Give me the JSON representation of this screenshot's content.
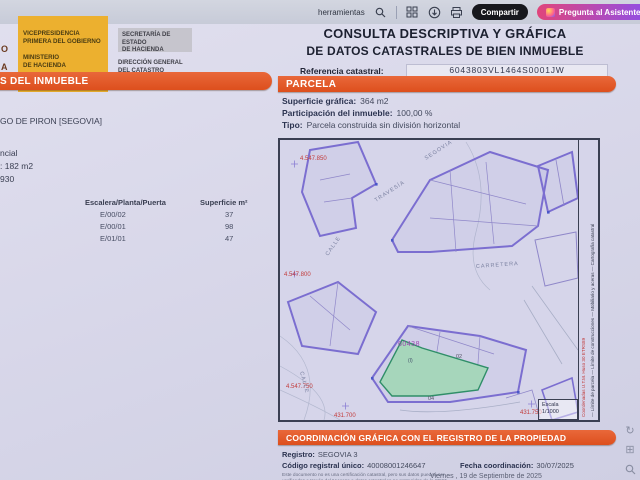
{
  "toolbar": {
    "tools_label": "herramientas",
    "share_label": "Compartir",
    "assistant_label": "Pregunta al Asistente"
  },
  "header": {
    "logo_partial_1": "O",
    "logo_partial_2": "A",
    "gov_box_line1": "VICEPRESIDENCIA",
    "gov_box_line2": "PRIMERA DEL GOBIERNO",
    "gov_box_line3": "MINISTERIO",
    "gov_box_line4": "DE HACIENDA",
    "secretary_line1": "SECRETARÍA DE ESTADO",
    "secretary_line2": "DE HACIENDA",
    "directorate_line1": "DIRECCIÓN GENERAL",
    "directorate_line2": "DEL CATASTRO",
    "title_line1": "CONSULTA DESCRIPTIVA Y GRÁFICA",
    "title_line2": "DE DATOS CATASTRALES DE BIEN INMUEBLE",
    "ref_label": "Referencia catastral:",
    "ref_value": "6043803VL1464S0001JW"
  },
  "left_panel": {
    "section_title": "S DEL INMUEBLE",
    "location_partial": "GO DE PIRON [SEGOVIA]",
    "use_partial": "ncial",
    "area_partial": ": 182 m2",
    "year_partial": "930",
    "table": {
      "col1": "Escalera/Planta/Puerta",
      "col2": "Superficie m²",
      "rows": [
        {
          "unit": "E/00/02",
          "area": "37"
        },
        {
          "unit": "E/00/01",
          "area": "98"
        },
        {
          "unit": "E/01/01",
          "area": "47"
        }
      ]
    }
  },
  "parcel_panel": {
    "section_title": "PARCELA",
    "graphic_area_label": "Superficie gráfica:",
    "graphic_area_value": "364 m2",
    "participation_label": "Participación del inmueble:",
    "participation_value": "100,00 %",
    "type_label": "Tipo:",
    "type_value": "Parcela construida sin división horizontal"
  },
  "map": {
    "street_travesia": "TRAVESÍA",
    "street_segovia": "SEGOVIA",
    "street_calle_left": "CALLE",
    "street_calle_bottom": "CALLE",
    "street_carretera": "CARRETERA",
    "coord_top": "4.547.850",
    "coord_mid": "4.547.800",
    "coord_bottom": "4.547.750",
    "coord_x1": "431.700",
    "coord_x2": "431.750",
    "block_number": "60438",
    "parcel_label_1": "(I)",
    "parcel_label_2": "02",
    "parcel_label_3": "04",
    "legend_red": "Coordenadas U.T.M. Huso 30 ETRS89",
    "legend_items": "— Límite de parcela   — Límite de construcciones   — Mobiliario y aceras   — Cartografía catastral",
    "scale_label": "Escala",
    "scale_value": "1/1000"
  },
  "coordination": {
    "section_title": "COORDINACIÓN GRÁFICA CON EL REGISTRO DE LA PROPIEDAD",
    "registry_label": "Registro:",
    "registry_value": "SEGOVIA 3",
    "code_label": "Código registral único:",
    "code_value": "40008001246647",
    "date_label": "Fecha coordinación:",
    "date_value": "30/07/2025",
    "disclaimer_line1": "Este documento no es una certificación catastral, pero sus datos pueden ser",
    "disclaimer_line2": "verificados a través del \"Acceso a datos catastrales no protegidos de la SEC\"",
    "print_date": "Viernes , 19 de Septiembre de 2025"
  }
}
